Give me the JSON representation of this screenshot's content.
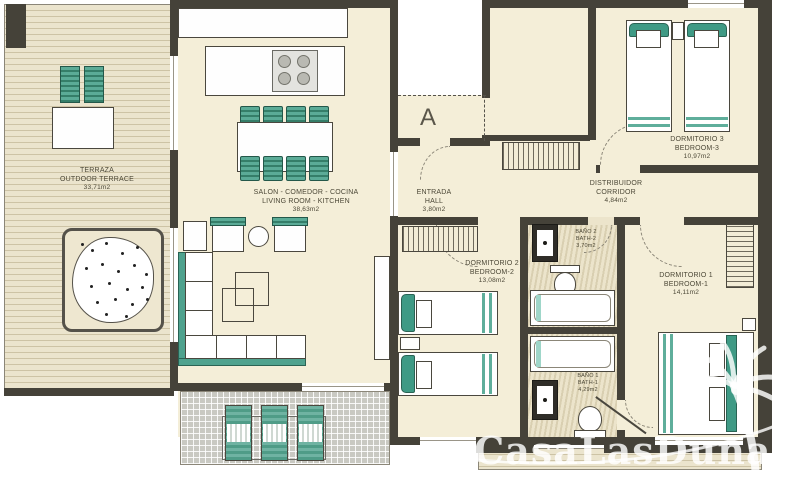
{
  "plan": {
    "unit_label": "A",
    "watermark": "CasaLasDunas",
    "colors": {
      "wall": "#454239",
      "floor": "#f4eed8",
      "accent_teal": "#4fa28e",
      "terrace_tile": "#c9c9c2",
      "watermark_white": "#ffffff"
    }
  },
  "rooms": {
    "terrace": {
      "name_es": "TERRAZA",
      "name_en": "OUTDOOR TERRACE",
      "area": "33,71m2"
    },
    "living": {
      "name_es": "SALON - COMEDOR - COCINA",
      "name_en": "LIVING ROOM - KITCHEN",
      "area": "38,63m2"
    },
    "hall": {
      "name_es": "ENTRADA",
      "name_en": "HALL",
      "area": "3,80m2"
    },
    "corridor": {
      "name_es": "DISTRIBUIDOR",
      "name_en": "CORRIDOR",
      "area": "4,84m2"
    },
    "bedroom3": {
      "name_es": "DORMITORIO 3",
      "name_en": "BEDROOM-3",
      "area": "10,97m2"
    },
    "bedroom2": {
      "name_es": "DORMITORIO 2",
      "name_en": "BEDROOM-2",
      "area": "13,08m2"
    },
    "bath2": {
      "name_es": "BAÑO 2",
      "name_en": "BATH-2",
      "area": "3,70m2"
    },
    "bedroom1": {
      "name_es": "DORMITORIO 1",
      "name_en": "BEDROOM-1",
      "area": "14,11m2"
    },
    "bath1": {
      "name_es": "BAÑO 1",
      "name_en": "BATH-1",
      "area": "4,29m2"
    }
  }
}
